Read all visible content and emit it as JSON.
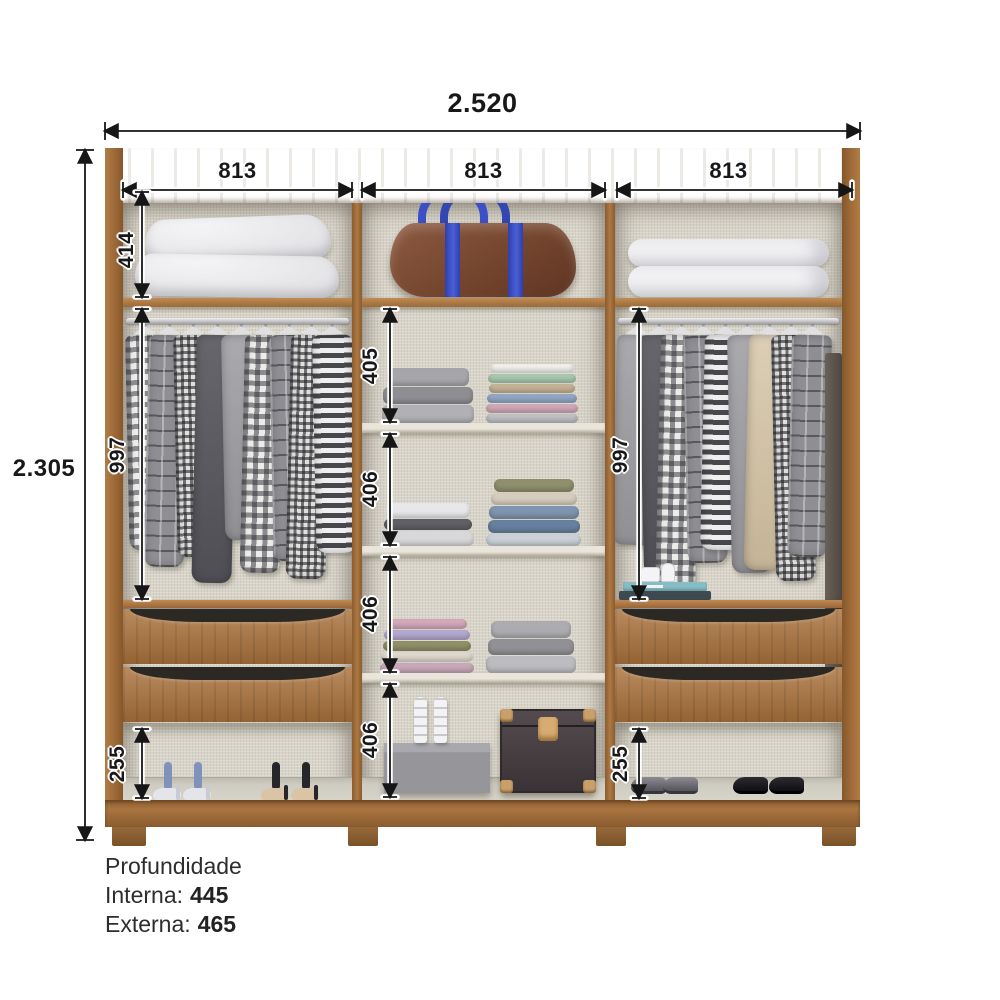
{
  "dims": {
    "total_width": "2.520",
    "total_height": "2.305",
    "sections": [
      "813",
      "813",
      "813"
    ],
    "top_compartment_height": "414",
    "hanging_left": "997",
    "hanging_right": "997",
    "middle_shelf_gaps": [
      "405",
      "406",
      "406",
      "406"
    ],
    "shoe_space_left": "255",
    "shoe_space_right": "255"
  },
  "depth": {
    "title": "Profundidade",
    "internal_label": "Interna:",
    "internal_value": "445",
    "external_label": "Externa:",
    "external_value": "465"
  },
  "colors": {
    "wood": "#a9743f",
    "wood_dark": "#8a5c2f",
    "interior_linen": "#d8d4c9",
    "dimension_ink": "#161616",
    "duffel_brown": "#74452e",
    "duffel_strap_blue": "#3d52c9",
    "background": "#ffffff"
  },
  "contents": {
    "top_row": [
      "pillows",
      "duffel-bag",
      "folded-duvets"
    ],
    "left_column": [
      "hanging-rod-with-shirts",
      "double-drawer-unit",
      "two-pairs-of-heels"
    ],
    "middle_column": [
      "folded-clothes-shelves",
      "sandals-on-shoe-box",
      "storage-trunk"
    ],
    "right_column": [
      "hanging-rod-with-shirts",
      "books-and-jars",
      "double-drawer-unit",
      "two-pairs-of-dress-shoes"
    ]
  }
}
